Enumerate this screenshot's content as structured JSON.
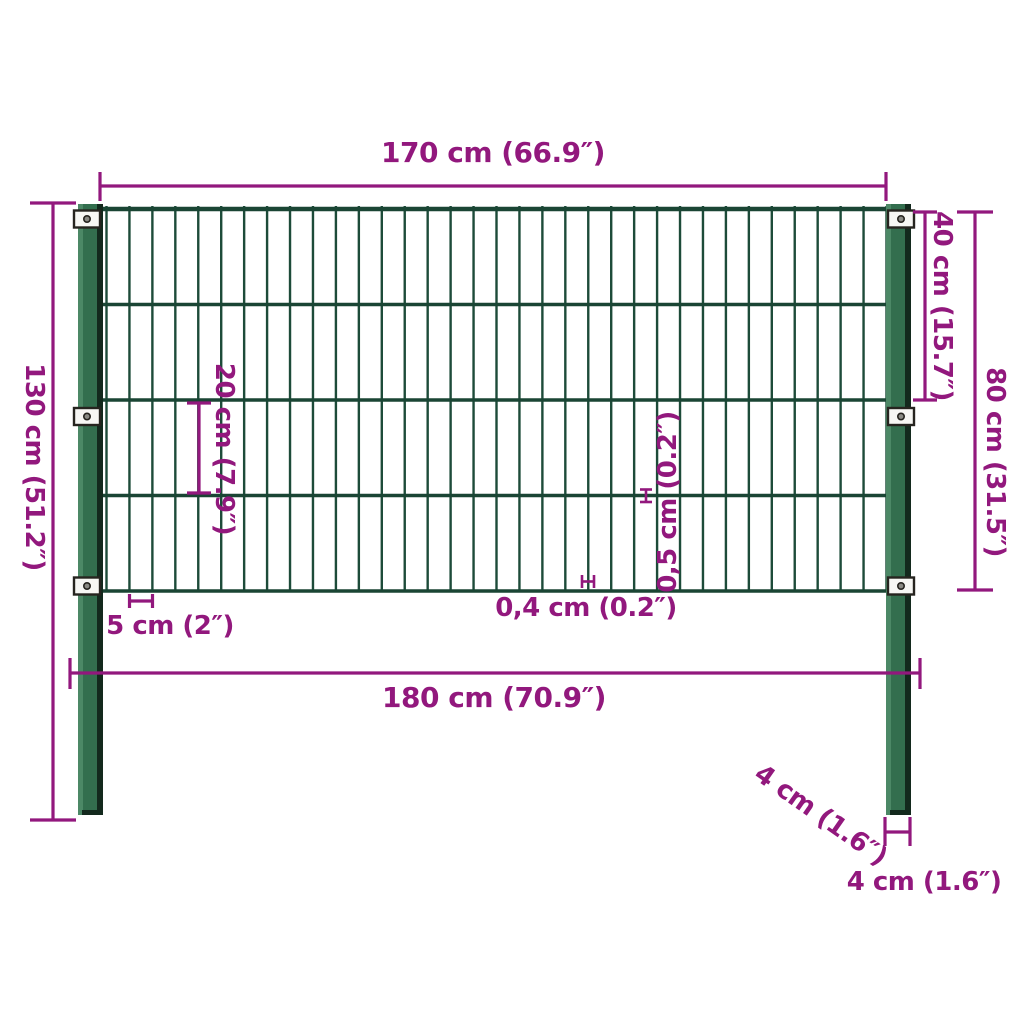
{
  "diagram": {
    "subject": "fence-panel-with-posts-dimension-drawing",
    "colors": {
      "dimension": "#92187D",
      "wire": "#1D4B39",
      "rail": "#1A4534",
      "post_body": "#336E4E",
      "post_highlight": "#4C8866",
      "post_shadow": "#13291D",
      "bracket_fill": "#F7F7F4",
      "bracket_border": "#26241F",
      "screw": "#8A8A84",
      "background": "#FFFFFF"
    },
    "structure": {
      "vertical_wires": 35,
      "horizontal_rails": 5,
      "posts": 2,
      "brackets_per_post": 3
    },
    "measurements": {
      "panel_width": {
        "label": "170 cm (66.9″)",
        "cm": 170,
        "inches": 66.9
      },
      "post_height": {
        "label": "130 cm (51.2″)",
        "cm": 130,
        "inches": 51.2
      },
      "upper_section_height": {
        "label": "40 cm (15.7″)",
        "cm": 40,
        "inches": 15.7
      },
      "panel_height": {
        "label": "80 cm (31.5″)",
        "cm": 80,
        "inches": 31.5
      },
      "row_height": {
        "label": "20 cm (7.9″)",
        "cm": 20,
        "inches": 7.9
      },
      "horizontal_wire_thickness": {
        "label": "0,5 cm (0.2″)",
        "cm": 0.5,
        "inches": 0.2
      },
      "vertical_wire_thickness": {
        "label": "0,4 cm (0.2″)",
        "cm": 0.4,
        "inches": 0.2
      },
      "wire_spacing": {
        "label": "5 cm (2″)",
        "cm": 5,
        "inches": 2
      },
      "total_width": {
        "label": "180 cm (70.9″)",
        "cm": 180,
        "inches": 70.9
      },
      "post_depth": {
        "label": "4 cm (1.6″)",
        "cm": 4,
        "inches": 1.6
      },
      "post_width": {
        "label": "4 cm (1.6″)",
        "cm": 4,
        "inches": 1.6
      }
    }
  }
}
